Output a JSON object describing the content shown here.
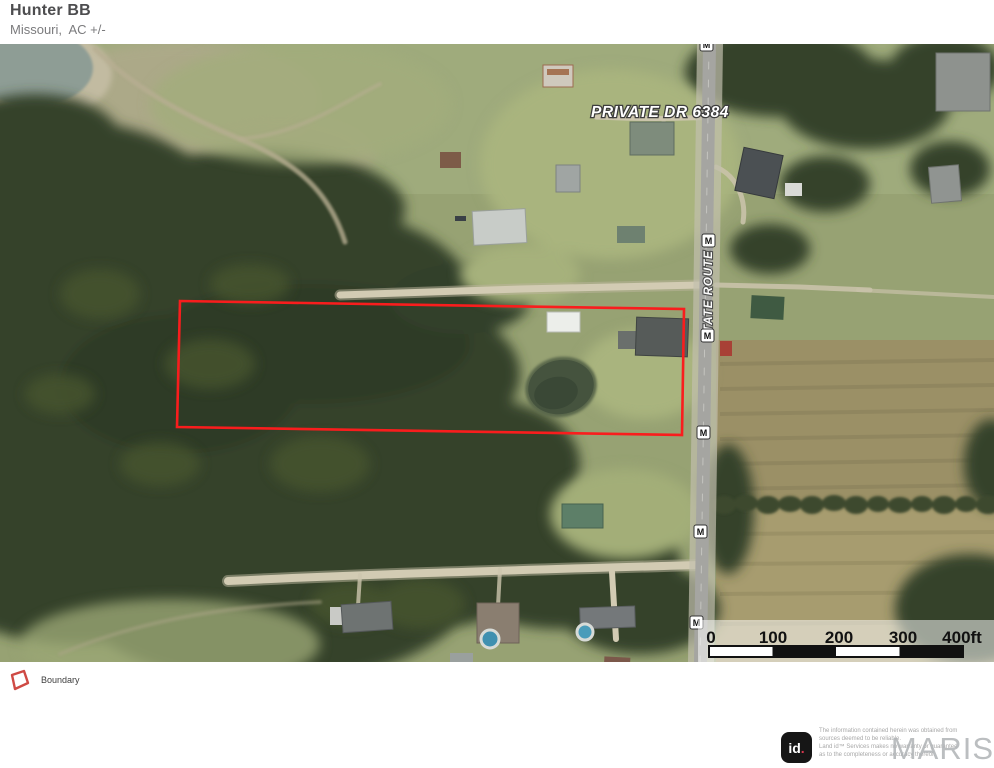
{
  "header": {
    "title": "Hunter BB",
    "subtitle": "Missouri,  AC +/-"
  },
  "map": {
    "private_drive_label": "PRIVATE DR 6384",
    "state_route_label": "STATE ROUTE M",
    "route_badge": "M",
    "scale_ticks": [
      "0",
      "100",
      "200",
      "300",
      "400ft"
    ],
    "boundary_color": "#f91d1d"
  },
  "legend": {
    "boundary_label": "Boundary"
  },
  "footer": {
    "logo_text": "id",
    "logo_dot": ".",
    "watermark": "MARIS",
    "disclaimer_line1": "The information contained herein was obtained from sources deemed to be reliable.",
    "disclaimer_line2": " Land id™ Services makes no warranty or guarantee as to the completeness or accuracy thereof."
  }
}
